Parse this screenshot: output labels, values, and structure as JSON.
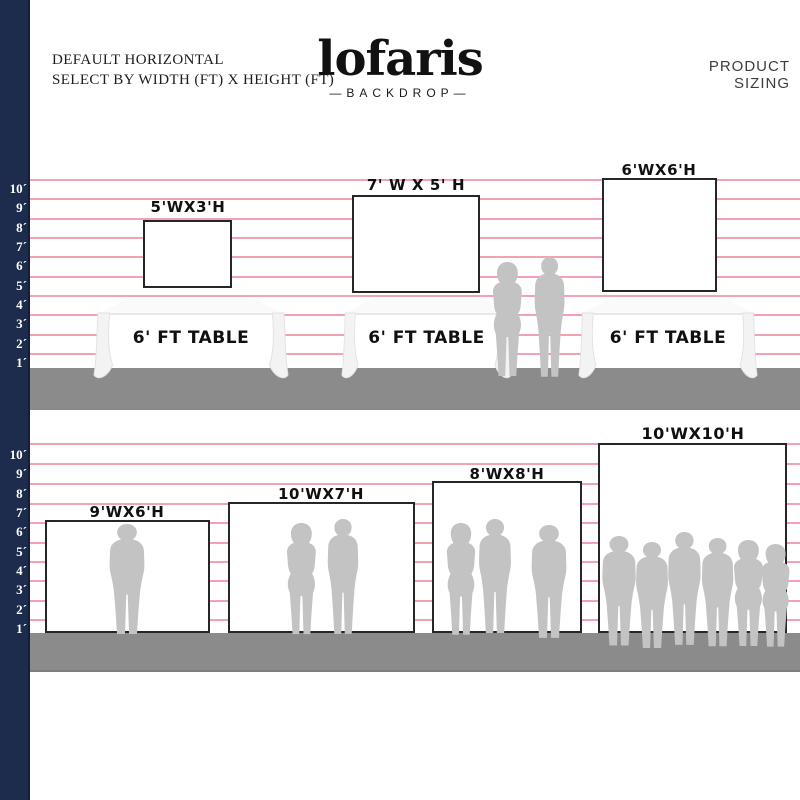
{
  "header": {
    "line1": "DEFAULT HORIZONTAL",
    "line2": "SELECT BY WIDTH (FT) X HEIGHT (FT)"
  },
  "brand": {
    "name": "lofaris",
    "subtitle": "—BACKDROP—"
  },
  "page_label": "PRODUCT SIZING",
  "ruler": {
    "labels": [
      "10´",
      "9´",
      "8´",
      "7´",
      "6´",
      "5´",
      "4´",
      "3´",
      "2´",
      "1´"
    ]
  },
  "top_section": {
    "backdrops": [
      {
        "label": "5'WX3'H"
      },
      {
        "label": "7' W X 5' H"
      },
      {
        "label": "6'WX6'H"
      }
    ],
    "table_label": "6' FT TABLE"
  },
  "bottom_section": {
    "backdrops": [
      {
        "label": "9'WX6'H"
      },
      {
        "label": "10'WX7'H"
      },
      {
        "label": "8'WX8'H"
      },
      {
        "label": "10'WX10'H"
      }
    ]
  },
  "colors": {
    "navy": "#1d2b4d",
    "pink_line": "#f2a2b2",
    "floor_gray": "#8b8b8b",
    "silhouette_gray": "#c3c3c3",
    "backdrop_border": "#262626"
  }
}
